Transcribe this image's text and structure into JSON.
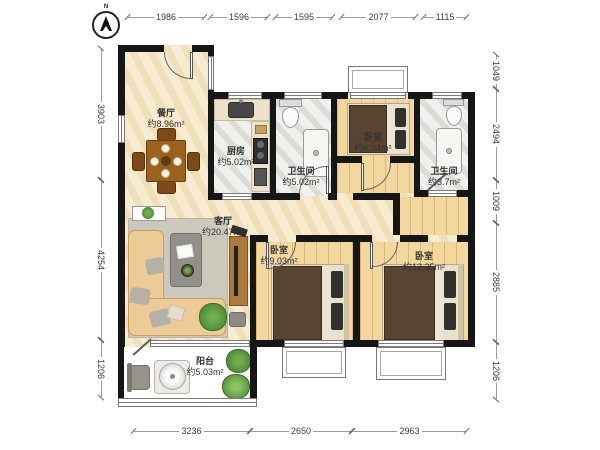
{
  "compass": {
    "label": "N"
  },
  "rooms": {
    "dining": {
      "name": "餐厅",
      "area": "约8.96m²"
    },
    "kitchen": {
      "name": "厨房",
      "area": "约5.02m²"
    },
    "bathroom_mid": {
      "name": "卫生间",
      "area": "约5.02m²"
    },
    "bedroom_north": {
      "name": "卧室",
      "area": "约6.34m²"
    },
    "bathroom_east": {
      "name": "卫生间",
      "area": "约3.7m²"
    },
    "living": {
      "name": "客厅",
      "area": "约20.47m²"
    },
    "bedroom_mid": {
      "name": "卧室",
      "area": "约9.03m²"
    },
    "bedroom_east": {
      "name": "卧室",
      "area": "约12.35m²"
    },
    "balcony": {
      "name": "阳台",
      "area": "约5.03m²"
    }
  },
  "dimensions": {
    "top": [
      "1986",
      "1596",
      "1595",
      "2077",
      "1115"
    ],
    "left": [
      "3903",
      "4254",
      "1206"
    ],
    "right": [
      "1049",
      "2494",
      "1009",
      "2885",
      "1206"
    ],
    "bottom": [
      "3236",
      "2650",
      "2963"
    ]
  },
  "colors": {
    "wall": "#161616",
    "floor_marble_cream": "#f4e7c6",
    "floor_marble_gray": "#eaeae6",
    "floor_wood": "#f2d79f",
    "floor_balcony_tile": "#f1e5bf",
    "bed_blanket": "#584430",
    "sofa": "#eccb96",
    "plant": "#57923c"
  }
}
